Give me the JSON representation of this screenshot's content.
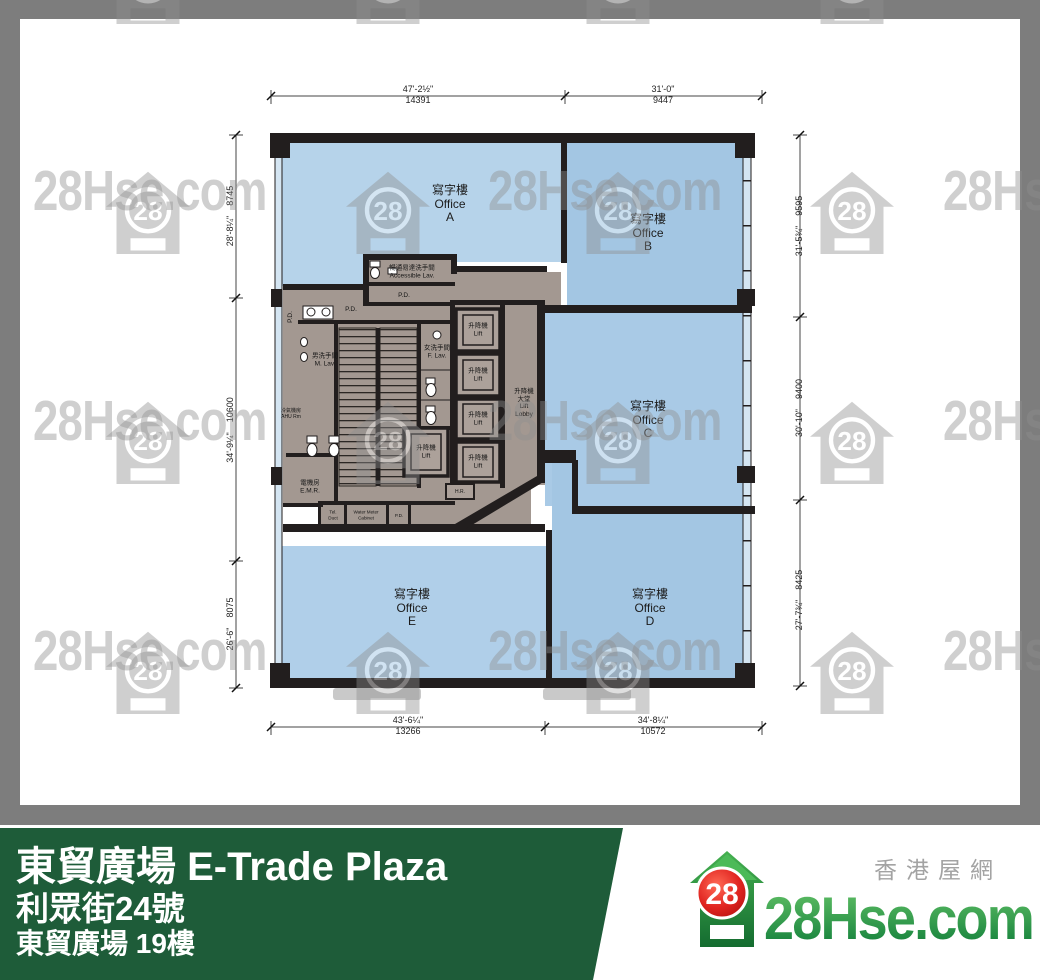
{
  "watermark": {
    "text": "28Hse.com",
    "badge": "28"
  },
  "plan": {
    "offices": {
      "zh": "寫字樓",
      "en": "Office",
      "units": [
        "A",
        "B",
        "C",
        "D",
        "E"
      ]
    },
    "rooms": {
      "accessible_lav_zh": "暢通易達洗手間",
      "accessible_lav_en": "Accessible Lav.",
      "m_lav_zh": "男洗手間",
      "m_lav_en": "M. Lav.",
      "f_lav_zh": "女洗手間",
      "f_lav_en": "F. Lav.",
      "ahu_zh": "冷氣機房",
      "ahu_en": "AHU Rm",
      "emr_zh": "電機房",
      "emr_en": "E.M.R.",
      "lift_zh": "升降機",
      "lift_en": "Lift",
      "lobby": [
        "升降機",
        "大堂",
        "Lift",
        "Lobby"
      ],
      "hr": "H.R.",
      "pd": "P.D.",
      "tel_duct": [
        "Tel.",
        "Duct"
      ],
      "water_meter": [
        "Water Meter",
        "Cabinet"
      ]
    },
    "dims": {
      "top": [
        {
          "ft": "47'-2½\"",
          "mm": "14391"
        },
        {
          "ft": "31'-0\"",
          "mm": "9447"
        }
      ],
      "bottom": [
        {
          "ft": "43'-6¼\"",
          "mm": "13266"
        },
        {
          "ft": "34'-8¼\"",
          "mm": "10572"
        }
      ],
      "left": [
        {
          "ft": "28'-8¼\"",
          "mm": "8745"
        },
        {
          "ft": "34'-9¼\"",
          "mm": "10600"
        },
        {
          "ft": "26'-6\"",
          "mm": "8075"
        }
      ],
      "right": [
        {
          "ft": "31'-5¾\"",
          "mm": "9595"
        },
        {
          "ft": "30'-10\"",
          "mm": "9400"
        },
        {
          "ft": "27'-7¾\"",
          "mm": "8425"
        }
      ]
    }
  },
  "footer": {
    "title": "東貿廣場 E-Trade Plaza",
    "address": "利眾街24號",
    "floor": "東貿廣場 19樓"
  },
  "brand": {
    "tagline": "香港屋網",
    "logo": "28Hse.com",
    "badge": "28",
    "green": "#1e5c39"
  }
}
